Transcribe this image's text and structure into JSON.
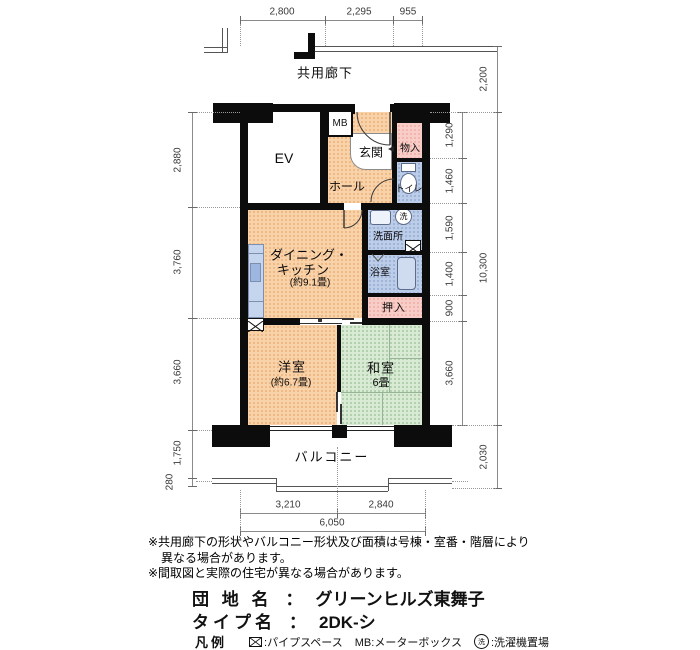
{
  "plan": {
    "corridor_label": "共用廊下",
    "rooms": {
      "elevator": "EV",
      "meter_box": "MB",
      "entrance": "玄関",
      "entry_storage": "物入",
      "toilet": "トイレ",
      "hall": "ホール",
      "washroom": "洗面所",
      "bathroom": "浴室",
      "futon_closet": "押入",
      "dining_kitchen_line1": "ダイニング・",
      "dining_kitchen_line2": "キッチン",
      "dining_kitchen_size": "(約9.1畳)",
      "western_room": "洋室",
      "western_room_size": "(約6.7畳)",
      "japanese_room": "和室",
      "japanese_room_size": "6畳",
      "balcony": "バルコニー",
      "washer_mark": "洗"
    },
    "dims": {
      "top": [
        "2,800",
        "2,295",
        "955"
      ],
      "left": [
        "2,880",
        "3,760",
        "3,660",
        "1,750",
        "280"
      ],
      "right_inner": [
        "1,290",
        "1,460",
        "1,590",
        "1,400",
        "900",
        "3,660"
      ],
      "right_outer": [
        "2,200",
        "10,300",
        "2,030"
      ],
      "bottom": [
        "3,210",
        "2,840",
        "6,050"
      ]
    }
  },
  "notes": [
    "※共用廊下の形状やバルコニー形状及び面積は号棟・室番・階層により",
    "異なる場合があります。",
    "※間取図と実際の住宅が異なる場合があります。"
  ],
  "title_block": {
    "estate_label": "団 地 名",
    "separator": "：",
    "estate_name": "グリーンヒルズ東舞子",
    "type_label": "タイプ名",
    "type_name": "2DK-シ"
  },
  "legend": {
    "label": "凡例",
    "pipe_space_text": ":パイプスペース",
    "meter_box_text": "MB:メーターボックス",
    "washer_symbol": "洗",
    "washer_text": ":洗濯機置場"
  },
  "colors": {
    "peach": "#f8d2a9",
    "green": "#d8e9d4",
    "pink": "#f8cdc7",
    "blue": "#bccde9",
    "wall": "#0c0c0c"
  }
}
